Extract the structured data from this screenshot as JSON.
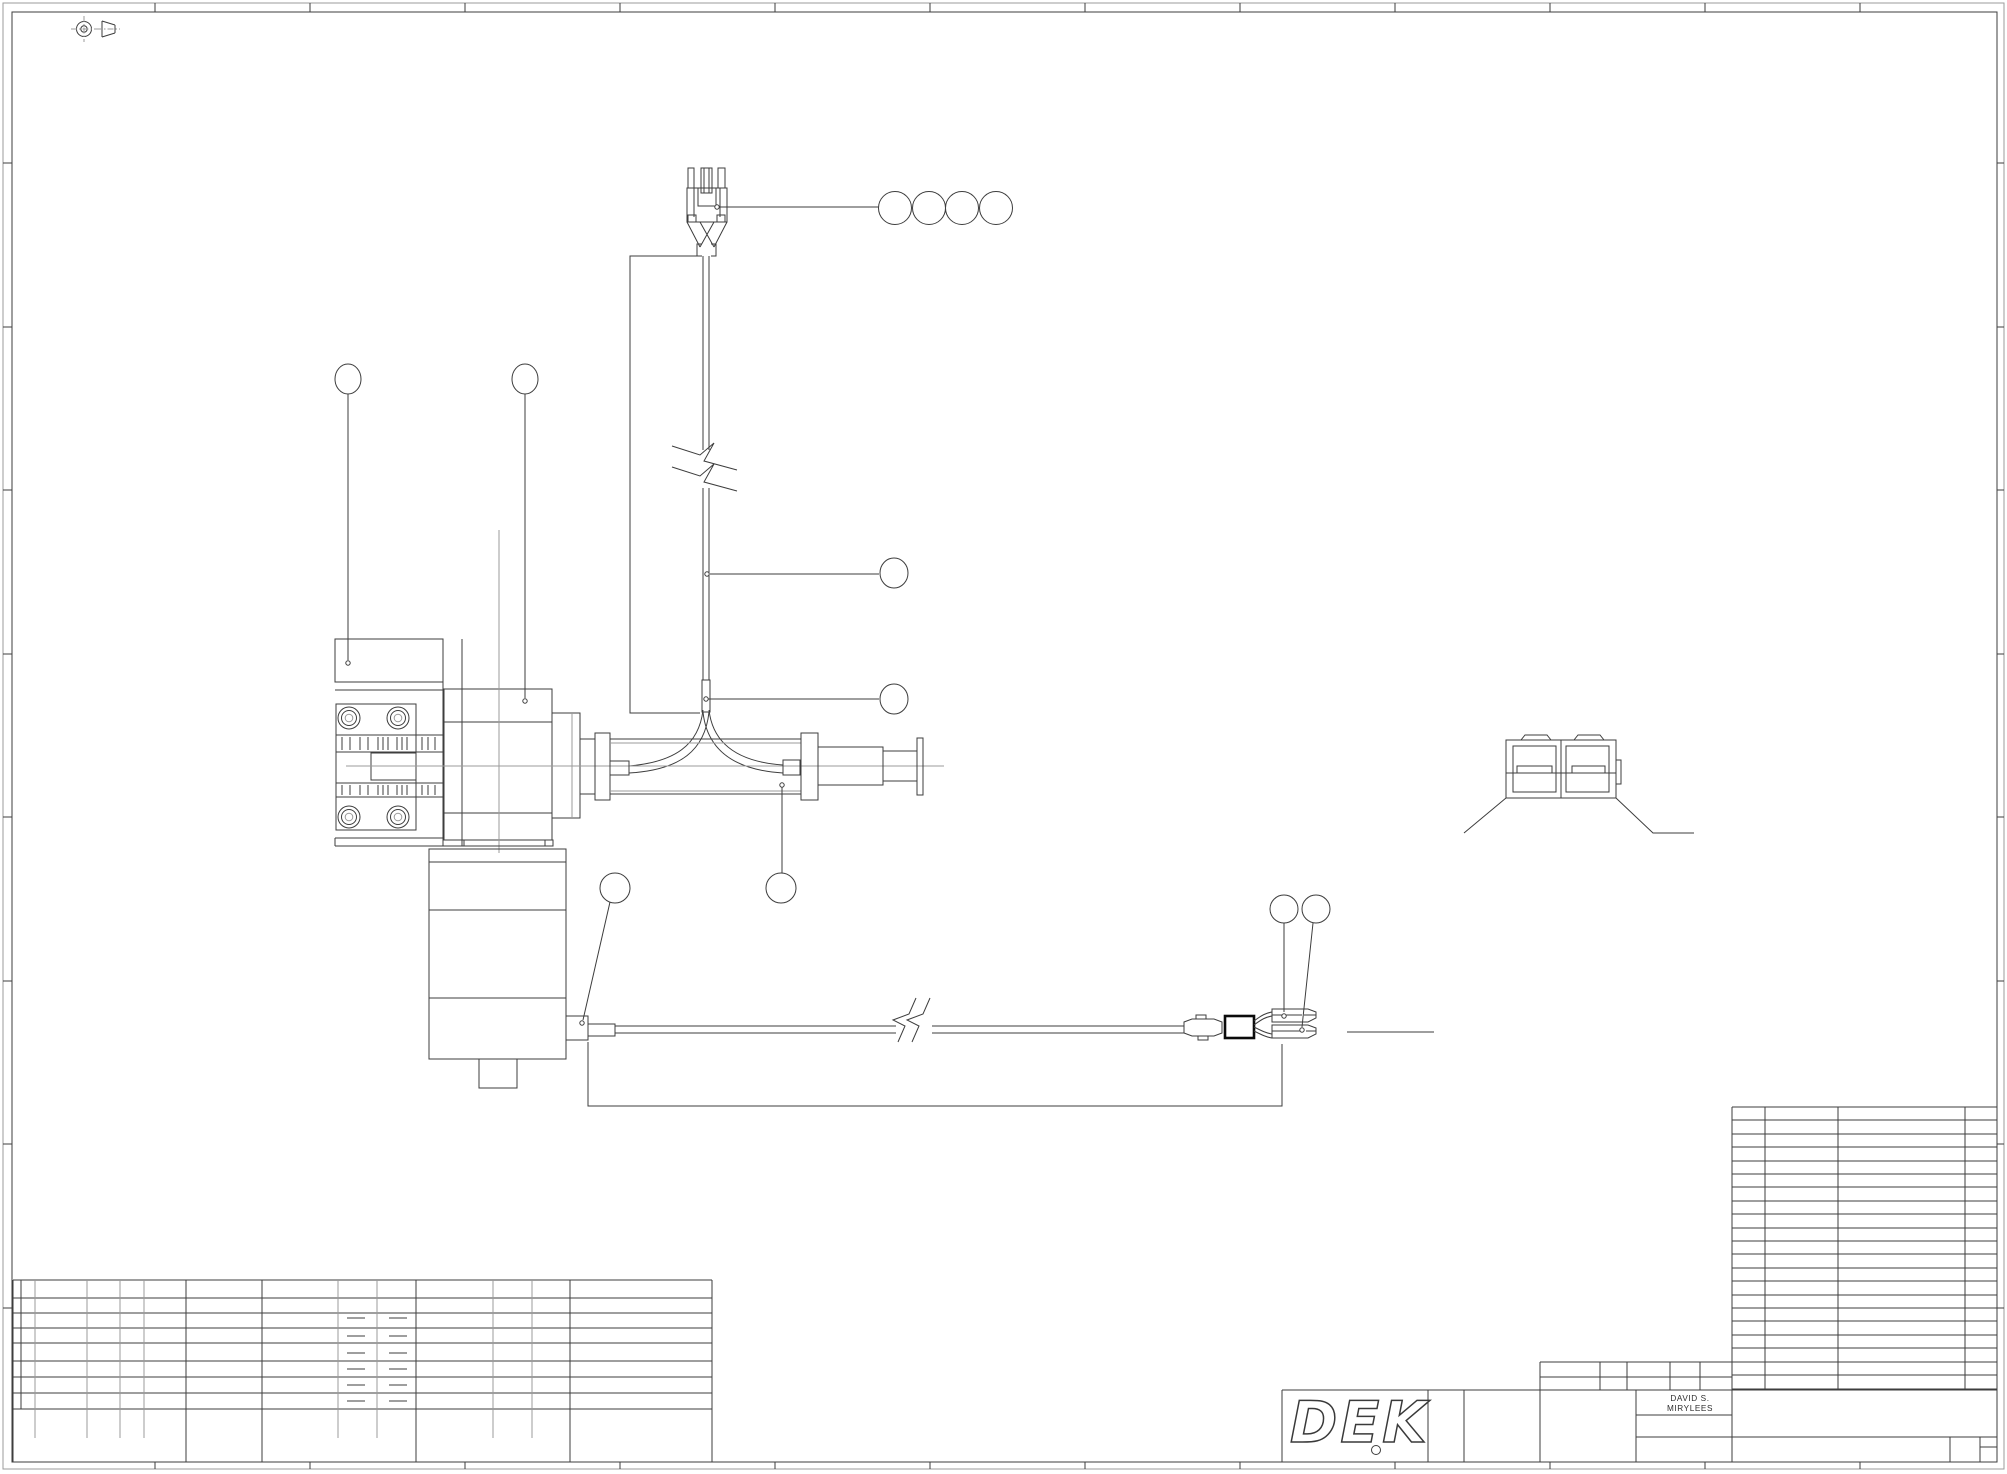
{
  "sheet": {
    "background": "#ffffff",
    "line_color": "#3d3d3d",
    "thin_line_color": "#9b9b9b",
    "accent_black": "#0a0a0a"
  },
  "title_block": {
    "drawn_by_line1": "DAVID S.",
    "drawn_by_line2": "MIRYLEES"
  },
  "logo": {
    "text": "DEK"
  },
  "callouts": {
    "balloon_count": 12,
    "labels": [
      "",
      "",
      "",
      "",
      "",
      "",
      "",
      "",
      "",
      "",
      "",
      ""
    ]
  },
  "symbols": {
    "projection": "first-angle-projection"
  }
}
